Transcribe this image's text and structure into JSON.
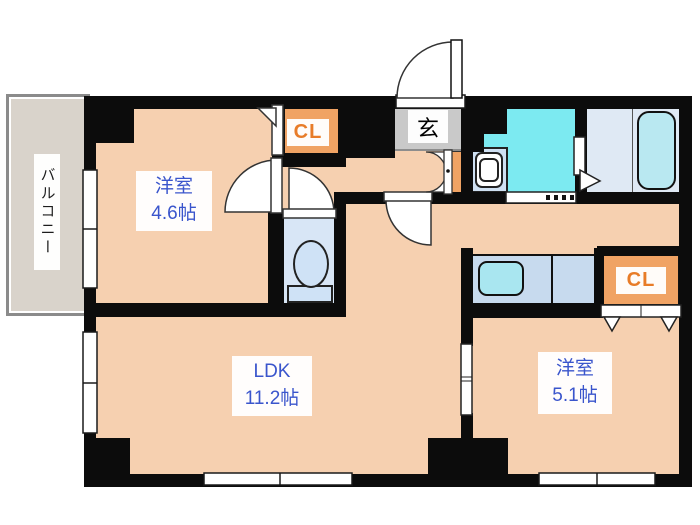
{
  "floorplan": {
    "balcony": {
      "label": "バルコニー"
    },
    "bedroom1": {
      "name": "洋室",
      "size": "4.6帖"
    },
    "ldk": {
      "name": "LDK",
      "size": "11.2帖"
    },
    "bedroom2": {
      "name": "洋室",
      "size": "5.1帖"
    },
    "entrance": {
      "label": "玄"
    },
    "closet_top": {
      "label": "CL"
    },
    "closet_right": {
      "label": "CL"
    },
    "colors": {
      "floor": "#f6d0b0",
      "wall": "#0c0c0c",
      "closet_fill": "#f0a364",
      "closet_text": "#e87c28",
      "room_text": "#3a55cc",
      "washroom_floor": "#7ceaf1",
      "bathroom_floor": "#dfe9f4",
      "toilet_floor": "#d8e6f6",
      "counter_fill": "#c7daee",
      "sink_fill": "#a9e6f0",
      "entrance_floor": "#c9c9c9",
      "balcony_floor": "#d9d3cb"
    }
  }
}
